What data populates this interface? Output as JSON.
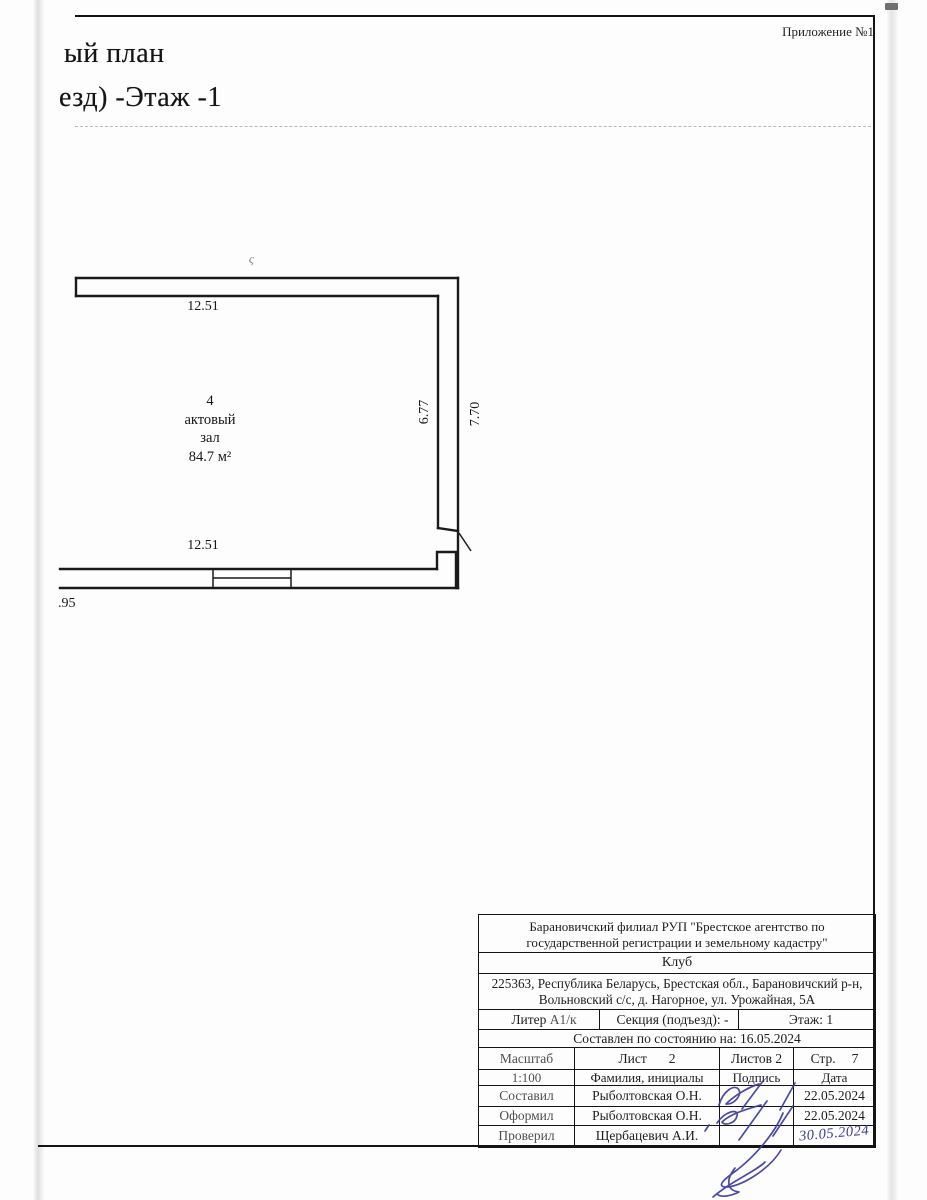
{
  "header": {
    "appendix": "Приложение №1",
    "title_fragment": "ый план",
    "subtitle_fragment": "езд) -Этаж -1"
  },
  "plan": {
    "room": {
      "number": "4",
      "name_line1": "актовый",
      "name_line2": "зал",
      "area": "84.7 м²"
    },
    "dimensions": {
      "top": "12.51",
      "bottom": "12.51",
      "inner_right": "6.77",
      "outer_right": "7.70",
      "left_partial": ".95"
    }
  },
  "artifact_mark": "ς",
  "title_block": {
    "organization": "Барановичский филиал РУП \"Брестское агентство по государственной регистрации и земельному кадастру\"",
    "object_name": "Клуб",
    "address": "225363, Республика Беларусь, Брестская обл., Барановичский р-н, Вольновский с/с, д. Нагорное, ул. Урожайная, 5А",
    "liter_label": "Литер",
    "liter_value": "А1/к",
    "section_label": "Секция (подъезд): -",
    "floor_label": "Этаж: 1",
    "compiled_label": "Составлен по состоянию на: 16.05.2024",
    "scale_label": "Масштаб",
    "sheet_label": "Лист",
    "sheet_number": "2",
    "sheets_total": "Листов 2",
    "page_label": "Стр.",
    "page_number": "7",
    "scale_value": "1:100",
    "name_header": "Фамилия, инициалы",
    "signature_header": "Подпись",
    "date_header": "Дата",
    "rows": [
      {
        "role": "Составил",
        "name": "Рыболтовская О.Н.",
        "date": "22.05.2024"
      },
      {
        "role": "Оформил",
        "name": "Рыболтовская О.Н.",
        "date": "22.05.2024"
      },
      {
        "role": "Проверил",
        "name": "Щербацевич А.И.",
        "date": "30.05.2024"
      }
    ]
  }
}
